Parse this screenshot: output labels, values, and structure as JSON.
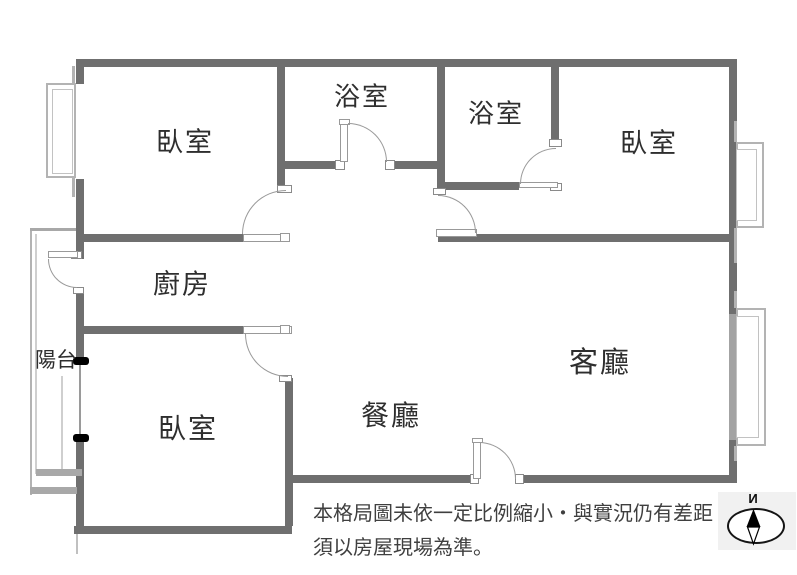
{
  "rooms": [
    {
      "id": "bedroom-top-left",
      "label": "臥室"
    },
    {
      "id": "bathroom-1",
      "label": "浴室"
    },
    {
      "id": "bathroom-2",
      "label": "浴室"
    },
    {
      "id": "bedroom-top-right",
      "label": "臥室"
    },
    {
      "id": "kitchen",
      "label": "廚房"
    },
    {
      "id": "balcony",
      "label": "陽台"
    },
    {
      "id": "bedroom-bottom-left",
      "label": "臥室"
    },
    {
      "id": "dining-room",
      "label": "餐廳"
    },
    {
      "id": "living-room",
      "label": "客廳"
    }
  ],
  "disclaimer": {
    "line1": "本格局圖未依一定比例縮小・與實況仍有差距・",
    "line2": "須以房屋現場為準。"
  },
  "compass": {
    "north_label": "N"
  },
  "colors": {
    "wall": "#6f6f6f",
    "window_line": "#b3b3b3",
    "balcony_line": "#a8a8a8",
    "door_arc": "#999999",
    "label_text": "#2e2e2e",
    "disclaimer_text": "#3f3f3f",
    "compass_bg": "#f1f1f1",
    "sliding_door_marker": "#000000"
  }
}
